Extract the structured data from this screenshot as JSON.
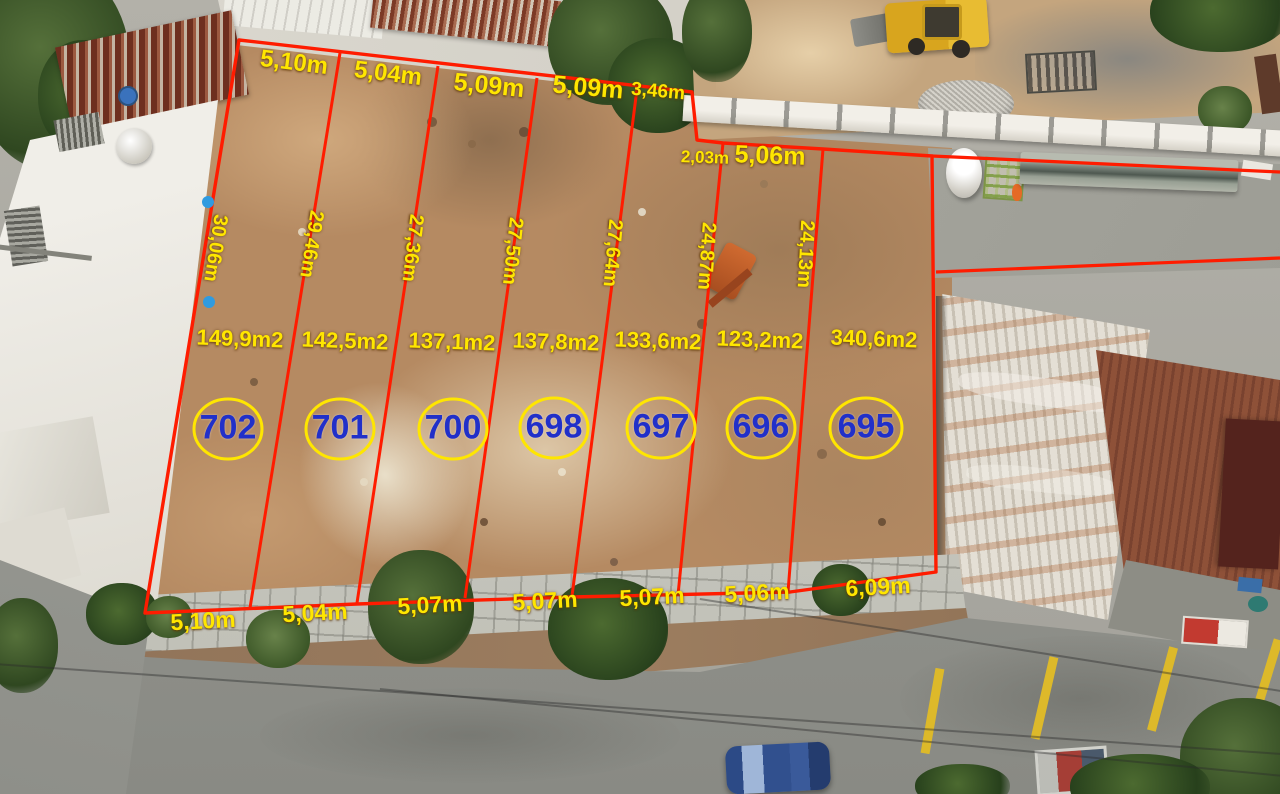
{
  "annotations": {
    "top_dims": [
      "5,10m",
      "5,04m",
      "5,09m",
      "5,09m",
      "3,46m"
    ],
    "step_dims": [
      "2,03m",
      "5,06m"
    ],
    "side_dims": [
      "30,06m",
      "29,46m",
      "27,36m",
      "27,50m",
      "27,64m",
      "24,87m",
      "24,13m"
    ],
    "areas": [
      "149,9m2",
      "142,5m2",
      "137,1m2",
      "137,8m2",
      "133,6m2",
      "123,2m2",
      "340,6m2"
    ],
    "lot_numbers": [
      "702",
      "701",
      "700",
      "698",
      "697",
      "696",
      "695"
    ],
    "bottom_dims": [
      "5,10m",
      "5,04m",
      "5,07m",
      "5,07m",
      "5,07m",
      "5,06m",
      "6,09m"
    ],
    "colors": {
      "boundary_red": "#ff1c00",
      "dimension_yellow": "#ffe600",
      "lot_number_blue": "#2130c9",
      "circle_yellow": "#ffe600",
      "marker_blue": "#2f9be0"
    }
  }
}
